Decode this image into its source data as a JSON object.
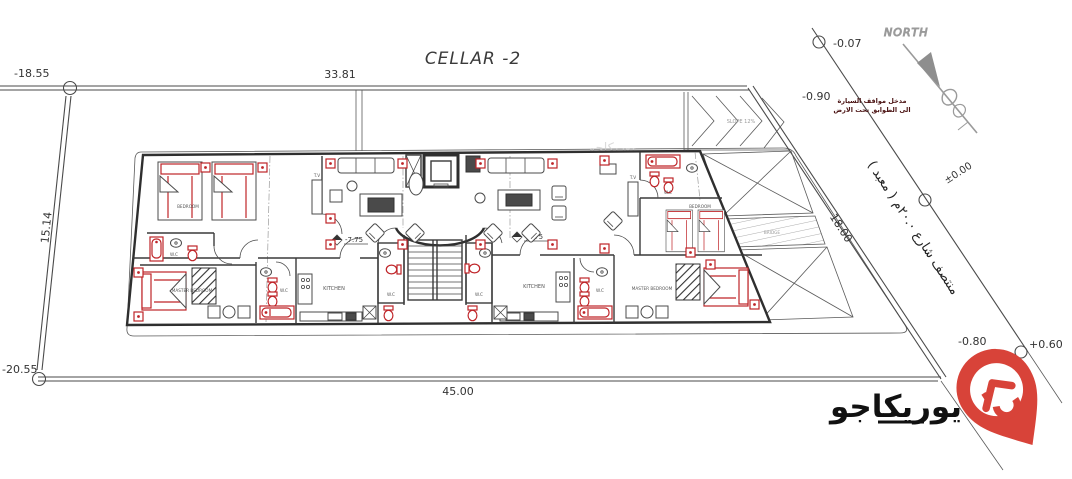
{
  "title": "CELLAR -2",
  "north": {
    "label": "NORTH"
  },
  "plot": {
    "dim_top": "33.81",
    "dim_left": "15.14",
    "dim_bottom": "45.00",
    "dim_street": "18.00",
    "level_top_left": "-18.55",
    "level_bottom_left": "-20.55"
  },
  "street": {
    "name_ar": "منتصف شارع ٢٠.٠م ( معبد )",
    "level_top": "-0.07",
    "level_center": "±0.00",
    "level_bottom_left": "-0.80",
    "level_bottom_right": "+0.60"
  },
  "ramp": {
    "slope_label": "SLOPE 12%",
    "level": "-0.90",
    "note_ar_line1": "مدخل مواقف السيارة",
    "note_ar_line2": "الى الطوابق تحت الارض"
  },
  "building": {
    "floor_level_left": "-7.75",
    "floor_level_right": "-7.75",
    "rooms": {
      "bedroom": "BEDROOM",
      "master_bedroom": "MASTER BEDROOM",
      "kitchen": "KITCHEN",
      "wc": "W.C",
      "tv": "T.V",
      "bridge": "BRIDGE"
    }
  },
  "logo": {
    "text_ar": "يوريكاجو"
  },
  "colors": {
    "ink": "#3a3a3a",
    "furniture_red": "#bf2428",
    "logo_red": "#d84339",
    "north_gray": "#9a9a9a"
  }
}
